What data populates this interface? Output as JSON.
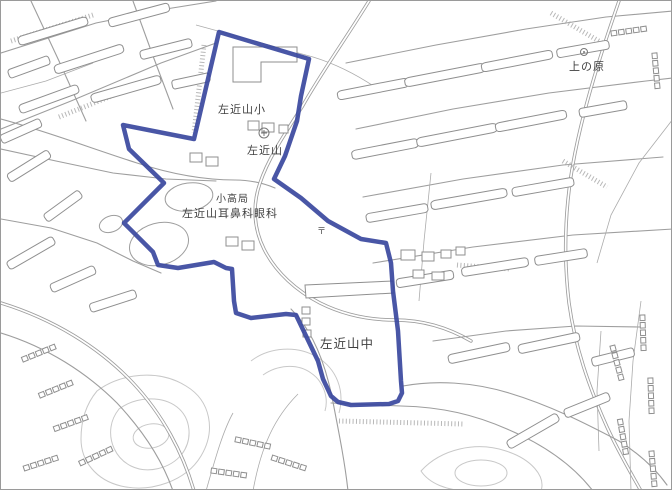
{
  "map": {
    "region_title": "左近山",
    "labels": [
      {
        "id": "sakonyama-elementary",
        "text": "左近山小"
      },
      {
        "id": "sakonyama",
        "text": "左近山"
      },
      {
        "id": "post-office",
        "text": "小高局"
      },
      {
        "id": "sakonyama-ent-eye-clinic",
        "text": "左近山耳鼻科眼科"
      },
      {
        "id": "sakonyama-junior-high",
        "text": "左近山中"
      },
      {
        "id": "uenohara",
        "text": "上の原"
      }
    ],
    "symbols": [
      {
        "id": "post-office-mark",
        "glyph": "〒"
      }
    ],
    "boundary": {
      "points": "218,31 308,58 300,95 296,120 284,155 273,178 300,197 327,220 360,238 385,242 390,262 392,290 397,330 400,380 401,392 397,400 388,403 350,404 337,401 330,395 322,378 317,360 295,314 285,313 250,317 235,312 233,300 231,268 225,267 213,261 195,264 177,267 157,264 152,251 123,222 163,182 128,148 122,124 193,138",
      "color": "#3a489e",
      "stroke_width": 4.5
    },
    "colors": {
      "background": "#ffffff",
      "road": "#9e9e9e",
      "building": "#8f8f8f",
      "contour": "#c8c8c8",
      "boundary": "#3a489e",
      "label": "#3f3f3f"
    }
  }
}
